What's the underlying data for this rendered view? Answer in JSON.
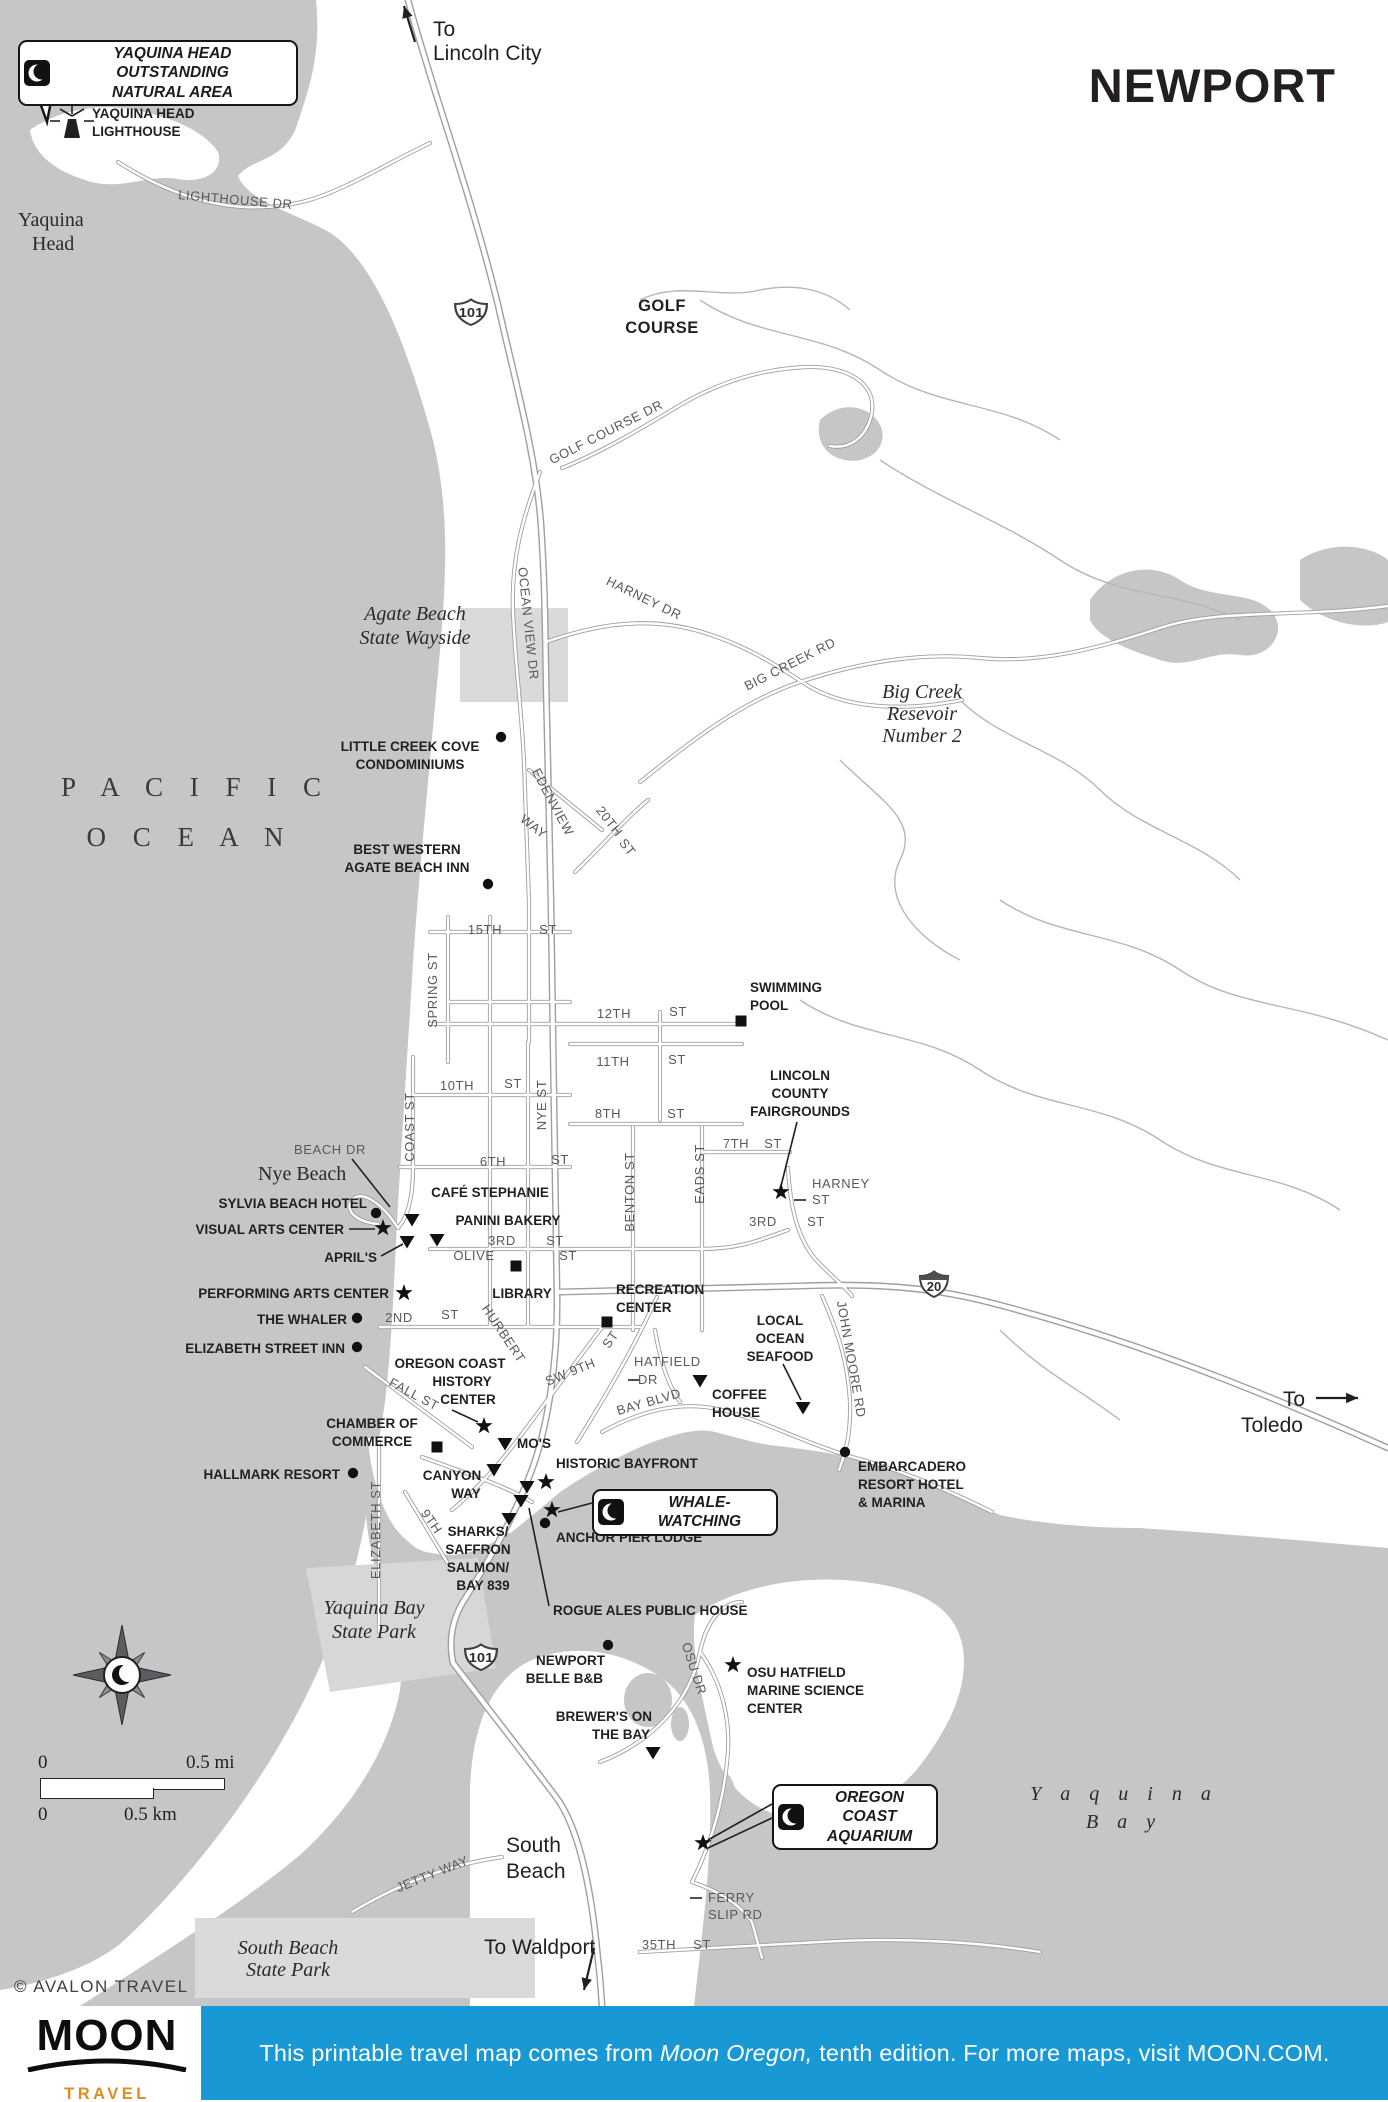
{
  "title": "NEWPORT",
  "attribution": "© AVALON TRAVEL",
  "colors": {
    "ocean": "#c5c6c8",
    "patch": "#d9dadc",
    "road_casing": "#9d9fa2",
    "road_fill": "#ffffff",
    "creek": "#b5b6b8",
    "text": "#231f20",
    "road_text": "#58595b",
    "footer_blue": "#1899d6",
    "logo_orange": "#e08a28"
  },
  "footer": {
    "logo_word": "MOON",
    "logo_sub": "TRAVEL GUIDES",
    "text_pre": "This printable travel map comes from ",
    "text_em": "Moon Oregon,",
    "text_post": " tenth edition. For more maps, visit MOON.COM."
  },
  "scalebar": {
    "mi0": "0",
    "mi1": "0.5 mi",
    "km0": "0",
    "km1": "0.5 km"
  },
  "callouts": [
    {
      "id": "yaquina-head-ona",
      "lines": [
        "YAQUINA HEAD OUTSTANDING",
        "NATURAL AREA"
      ],
      "x": 18,
      "y": 40,
      "w": 280,
      "h": 50
    },
    {
      "id": "whale-watching",
      "lines": [
        "WHALE-WATCHING"
      ],
      "x": 592,
      "y": 1489,
      "w": 186,
      "h": 30
    },
    {
      "id": "oregon-coast-aquarium",
      "lines": [
        "OREGON COAST",
        "AQUARIUM"
      ],
      "x": 772,
      "y": 1784,
      "w": 166,
      "h": 52
    }
  ],
  "shields": [
    {
      "n": "101",
      "x": 471,
      "y": 312,
      "w": 34,
      "band": false
    },
    {
      "n": "101",
      "x": 481,
      "y": 1657,
      "w": 34,
      "band": false
    },
    {
      "n": "20",
      "x": 934,
      "y": 1284,
      "w": 30,
      "band": true
    }
  ],
  "arrows": [
    {
      "x1": 415,
      "y1": 42,
      "x2": 404,
      "y2": 6
    },
    {
      "x1": 1316,
      "y1": 1398,
      "x2": 1358,
      "y2": 1398
    },
    {
      "x1": 594,
      "y1": 1948,
      "x2": 584,
      "y2": 1990
    }
  ],
  "leaders": [
    [
      797,
      1122,
      781,
      1186
    ],
    [
      783,
      1364,
      801,
      1400
    ],
    [
      549,
      1606,
      529,
      1508
    ],
    [
      349,
      1229,
      375,
      1229
    ],
    [
      381,
      1256,
      403,
      1244
    ],
    [
      592,
      1503,
      558,
      1512
    ],
    [
      772,
      1804,
      708,
      1840
    ],
    [
      772,
      1818,
      708,
      1848
    ],
    [
      452,
      1410,
      478,
      1422
    ],
    [
      352,
      1159,
      390,
      1207
    ],
    [
      628,
      1380,
      640,
      1380
    ],
    [
      794,
      1200,
      806,
      1200
    ],
    [
      690,
      1898,
      702,
      1898
    ]
  ],
  "markers": [
    {
      "k": "dot",
      "x": 501,
      "y": 737
    },
    {
      "k": "dot",
      "x": 488,
      "y": 884
    },
    {
      "k": "dot",
      "x": 376,
      "y": 1213
    },
    {
      "k": "dot",
      "x": 357,
      "y": 1318
    },
    {
      "k": "dot",
      "x": 357,
      "y": 1347
    },
    {
      "k": "dot",
      "x": 353,
      "y": 1473
    },
    {
      "k": "dot",
      "x": 545,
      "y": 1523
    },
    {
      "k": "dot",
      "x": 845,
      "y": 1452
    },
    {
      "k": "dot",
      "x": 608,
      "y": 1645
    },
    {
      "k": "star",
      "x": 383,
      "y": 1228
    },
    {
      "k": "star",
      "x": 404,
      "y": 1293
    },
    {
      "k": "star",
      "x": 781,
      "y": 1192
    },
    {
      "k": "star",
      "x": 546,
      "y": 1482
    },
    {
      "k": "star",
      "x": 552,
      "y": 1510
    },
    {
      "k": "star",
      "x": 733,
      "y": 1665
    },
    {
      "k": "star",
      "x": 703,
      "y": 1843
    },
    {
      "k": "star",
      "x": 484,
      "y": 1426
    },
    {
      "k": "tri",
      "x": 412,
      "y": 1220
    },
    {
      "k": "tri",
      "x": 437,
      "y": 1240
    },
    {
      "k": "tri",
      "x": 407,
      "y": 1242
    },
    {
      "k": "tri",
      "x": 700,
      "y": 1381
    },
    {
      "k": "tri",
      "x": 803,
      "y": 1408
    },
    {
      "k": "tri",
      "x": 494,
      "y": 1470
    },
    {
      "k": "tri",
      "x": 527,
      "y": 1487
    },
    {
      "k": "tri",
      "x": 521,
      "y": 1501
    },
    {
      "k": "tri",
      "x": 509,
      "y": 1519
    },
    {
      "k": "tri",
      "x": 653,
      "y": 1753
    },
    {
      "k": "tri",
      "x": 505,
      "y": 1444
    },
    {
      "k": "sq",
      "x": 741,
      "y": 1021
    },
    {
      "k": "sq",
      "x": 516,
      "y": 1266
    },
    {
      "k": "sq",
      "x": 607,
      "y": 1322
    },
    {
      "k": "sq",
      "x": 437,
      "y": 1447
    }
  ],
  "labels": [
    {
      "t": "To",
      "x": 433,
      "y": 36,
      "c": "plain",
      "a": "s"
    },
    {
      "t": "Lincoln City",
      "x": 433,
      "y": 60,
      "c": "plain",
      "a": "s"
    },
    {
      "t": "YAQUINA HEAD",
      "x": 92,
      "y": 118,
      "c": "poi",
      "a": "s"
    },
    {
      "t": "LIGHTHOUSE",
      "x": 92,
      "y": 136,
      "c": "poi",
      "a": "s"
    },
    {
      "t": "Yaquina",
      "x": 18,
      "y": 226,
      "c": "placer",
      "a": "s"
    },
    {
      "t": "Head",
      "x": 32,
      "y": 250,
      "c": "placer",
      "a": "s"
    },
    {
      "t": "LIGHTHOUSE DR",
      "x": 235,
      "y": 204,
      "c": "road",
      "r": 5
    },
    {
      "t": "GOLF",
      "x": 662,
      "y": 311,
      "c": "poilg"
    },
    {
      "t": "COURSE",
      "x": 662,
      "y": 333,
      "c": "poilg"
    },
    {
      "t": "GOLF COURSE DR",
      "x": 608,
      "y": 436,
      "c": "road",
      "r": -27
    },
    {
      "t": "Agate Beach",
      "x": 415,
      "y": 620,
      "c": "place"
    },
    {
      "t": "State Wayside",
      "x": 415,
      "y": 644,
      "c": "place"
    },
    {
      "t": "OCEAN VIEW DR",
      "x": 524,
      "y": 624,
      "c": "road",
      "r": 84
    },
    {
      "t": "HARNEY DR",
      "x": 642,
      "y": 602,
      "c": "road",
      "r": 26
    },
    {
      "t": "BIG CREEK RD",
      "x": 792,
      "y": 668,
      "c": "road",
      "r": -27
    },
    {
      "t": "Big Creek",
      "x": 922,
      "y": 698,
      "c": "place"
    },
    {
      "t": "Resevoir",
      "x": 922,
      "y": 720,
      "c": "place"
    },
    {
      "t": "Number 2",
      "x": 922,
      "y": 742,
      "c": "place"
    },
    {
      "t": "P A C I F I C",
      "x": 196,
      "y": 796,
      "c": "ocean"
    },
    {
      "t": "O C E A N",
      "x": 190,
      "y": 846,
      "c": "ocean"
    },
    {
      "t": "LITTLE CREEK COVE",
      "x": 410,
      "y": 751,
      "c": "poi"
    },
    {
      "t": "CONDOMINIUMS",
      "x": 410,
      "y": 769,
      "c": "poi"
    },
    {
      "t": "BEST WESTERN",
      "x": 407,
      "y": 854,
      "c": "poi"
    },
    {
      "t": "AGATE BEACH INN",
      "x": 407,
      "y": 872,
      "c": "poi"
    },
    {
      "t": "EDENVIEW",
      "x": 549,
      "y": 804,
      "c": "road",
      "r": 62
    },
    {
      "t": "WAY",
      "x": 531,
      "y": 830,
      "c": "road",
      "r": 38
    },
    {
      "t": "20TH",
      "x": 606,
      "y": 824,
      "c": "road",
      "r": 52
    },
    {
      "t": "ST",
      "x": 624,
      "y": 850,
      "c": "road",
      "r": 52
    },
    {
      "t": "SWIMMING",
      "x": 750,
      "y": 992,
      "c": "poi",
      "a": "s"
    },
    {
      "t": "POOL",
      "x": 750,
      "y": 1010,
      "c": "poi",
      "a": "s"
    },
    {
      "t": "15TH",
      "x": 485,
      "y": 934,
      "c": "road"
    },
    {
      "t": "ST",
      "x": 548,
      "y": 934,
      "c": "road"
    },
    {
      "t": "SPRING ST",
      "x": 437,
      "y": 990,
      "c": "road",
      "r": -90
    },
    {
      "t": "12TH",
      "x": 614,
      "y": 1018,
      "c": "road"
    },
    {
      "t": "ST",
      "x": 678,
      "y": 1016,
      "c": "road"
    },
    {
      "t": "11TH",
      "x": 613,
      "y": 1066,
      "c": "road"
    },
    {
      "t": "ST",
      "x": 677,
      "y": 1064,
      "c": "road"
    },
    {
      "t": "8TH",
      "x": 608,
      "y": 1118,
      "c": "road"
    },
    {
      "t": "ST",
      "x": 676,
      "y": 1118,
      "c": "road"
    },
    {
      "t": "10TH",
      "x": 457,
      "y": 1090,
      "c": "road"
    },
    {
      "t": "ST",
      "x": 513,
      "y": 1088,
      "c": "road"
    },
    {
      "t": "LINCOLN",
      "x": 800,
      "y": 1080,
      "c": "poi"
    },
    {
      "t": "COUNTY",
      "x": 800,
      "y": 1098,
      "c": "poi"
    },
    {
      "t": "FAIRGROUNDS",
      "x": 800,
      "y": 1116,
      "c": "poi"
    },
    {
      "t": "7TH",
      "x": 736,
      "y": 1148,
      "c": "road"
    },
    {
      "t": "ST",
      "x": 773,
      "y": 1148,
      "c": "road"
    },
    {
      "t": "6TH",
      "x": 493,
      "y": 1166,
      "c": "road"
    },
    {
      "t": "ST",
      "x": 560,
      "y": 1164,
      "c": "road"
    },
    {
      "t": "NYE ST",
      "x": 546,
      "y": 1105,
      "c": "road",
      "r": -90
    },
    {
      "t": "COAST ST",
      "x": 414,
      "y": 1127,
      "c": "road",
      "r": -90
    },
    {
      "t": "BENTON ST",
      "x": 634,
      "y": 1192,
      "c": "road",
      "r": -90
    },
    {
      "t": "EADS ST",
      "x": 704,
      "y": 1174,
      "c": "road",
      "r": -90
    },
    {
      "t": "BEACH DR",
      "x": 330,
      "y": 1154,
      "c": "road"
    },
    {
      "t": "Nye Beach",
      "x": 258,
      "y": 1180,
      "c": "placer",
      "a": "s"
    },
    {
      "t": "HARNEY",
      "x": 812,
      "y": 1188,
      "c": "road",
      "a": "s"
    },
    {
      "t": "ST",
      "x": 812,
      "y": 1204,
      "c": "road",
      "a": "s"
    },
    {
      "t": "3RD",
      "x": 763,
      "y": 1226,
      "c": "road"
    },
    {
      "t": "ST",
      "x": 816,
      "y": 1226,
      "c": "road"
    },
    {
      "t": "CAFÉ STEPHANIE",
      "x": 490,
      "y": 1197,
      "c": "poi"
    },
    {
      "t": "SYLVIA BEACH HOTEL",
      "x": 367,
      "y": 1208,
      "c": "poi",
      "a": "e"
    },
    {
      "t": "PANINI BAKERY",
      "x": 508,
      "y": 1225,
      "c": "poi"
    },
    {
      "t": "VISUAL ARTS CENTER",
      "x": 344,
      "y": 1234,
      "c": "poi",
      "a": "e"
    },
    {
      "t": "3RD",
      "x": 502,
      "y": 1245,
      "c": "road"
    },
    {
      "t": "ST",
      "x": 555,
      "y": 1245,
      "c": "road"
    },
    {
      "t": "OLIVE",
      "x": 474,
      "y": 1260,
      "c": "road"
    },
    {
      "t": "ST",
      "x": 568,
      "y": 1260,
      "c": "road"
    },
    {
      "t": "APRIL'S",
      "x": 377,
      "y": 1262,
      "c": "poi",
      "a": "e"
    },
    {
      "t": "PERFORMING ARTS CENTER",
      "x": 389,
      "y": 1298,
      "c": "poi",
      "a": "e"
    },
    {
      "t": "LIBRARY",
      "x": 522,
      "y": 1298,
      "c": "poi"
    },
    {
      "t": "RECREATION",
      "x": 616,
      "y": 1294,
      "c": "poi",
      "a": "s"
    },
    {
      "t": "CENTER",
      "x": 616,
      "y": 1312,
      "c": "poi",
      "a": "s"
    },
    {
      "t": "THE WHALER",
      "x": 347,
      "y": 1324,
      "c": "poi",
      "a": "e"
    },
    {
      "t": "2ND",
      "x": 399,
      "y": 1322,
      "c": "road"
    },
    {
      "t": "ST",
      "x": 450,
      "y": 1319,
      "c": "road"
    },
    {
      "t": "ELIZABETH STREET INN",
      "x": 345,
      "y": 1353,
      "c": "poi",
      "a": "e"
    },
    {
      "t": "LOCAL",
      "x": 780,
      "y": 1325,
      "c": "poi"
    },
    {
      "t": "OCEAN",
      "x": 780,
      "y": 1343,
      "c": "poi"
    },
    {
      "t": "SEAFOOD",
      "x": 780,
      "y": 1361,
      "c": "poi"
    },
    {
      "t": "JOHN MOORE RD",
      "x": 847,
      "y": 1360,
      "c": "road",
      "r": 80
    },
    {
      "t": "OREGON COAST",
      "x": 450,
      "y": 1368,
      "c": "poi"
    },
    {
      "t": "HISTORY",
      "x": 462,
      "y": 1386,
      "c": "poi"
    },
    {
      "t": "CENTER",
      "x": 468,
      "y": 1404,
      "c": "poi"
    },
    {
      "t": "HURBERT",
      "x": 500,
      "y": 1336,
      "c": "road",
      "r": 56
    },
    {
      "t": "SW 9TH",
      "x": 572,
      "y": 1376,
      "c": "road",
      "r": -22
    },
    {
      "t": "ST",
      "x": 614,
      "y": 1342,
      "c": "road",
      "r": -55
    },
    {
      "t": "HATFIELD",
      "x": 634,
      "y": 1366,
      "c": "road",
      "a": "s"
    },
    {
      "t": "DR",
      "x": 638,
      "y": 1384,
      "c": "road",
      "a": "s"
    },
    {
      "t": "BAY BLVD",
      "x": 650,
      "y": 1406,
      "c": "road",
      "r": -16
    },
    {
      "t": "COFFEE",
      "x": 712,
      "y": 1399,
      "c": "poi",
      "a": "s"
    },
    {
      "t": "HOUSE",
      "x": 712,
      "y": 1417,
      "c": "poi",
      "a": "s"
    },
    {
      "t": "FALL ST",
      "x": 412,
      "y": 1398,
      "c": "road",
      "r": 28
    },
    {
      "t": "CHAMBER OF",
      "x": 372,
      "y": 1428,
      "c": "poi"
    },
    {
      "t": "COMMERCE",
      "x": 372,
      "y": 1446,
      "c": "poi"
    },
    {
      "t": "MO'S",
      "x": 517,
      "y": 1448,
      "c": "poi",
      "a": "s"
    },
    {
      "t": "HISTORIC BAYFRONT",
      "x": 556,
      "y": 1468,
      "c": "poi",
      "a": "s"
    },
    {
      "t": "EMBARCADERO",
      "x": 858,
      "y": 1471,
      "c": "poi",
      "a": "s"
    },
    {
      "t": "RESORT HOTEL",
      "x": 858,
      "y": 1489,
      "c": "poi",
      "a": "s"
    },
    {
      "t": "& MARINA",
      "x": 858,
      "y": 1507,
      "c": "poi",
      "a": "s"
    },
    {
      "t": "HALLMARK RESORT",
      "x": 340,
      "y": 1479,
      "c": "poi",
      "a": "e"
    },
    {
      "t": "CANYON",
      "x": 452,
      "y": 1480,
      "c": "poi"
    },
    {
      "t": "WAY",
      "x": 466,
      "y": 1498,
      "c": "poi"
    },
    {
      "t": "ELIZABETH ST",
      "x": 380,
      "y": 1530,
      "c": "road",
      "r": -90
    },
    {
      "t": "9TH",
      "x": 428,
      "y": 1524,
      "c": "road",
      "r": 55
    },
    {
      "t": "SHARKS/",
      "x": 478,
      "y": 1536,
      "c": "poi"
    },
    {
      "t": "SAFFRON",
      "x": 478,
      "y": 1554,
      "c": "poi"
    },
    {
      "t": "SALMON/",
      "x": 478,
      "y": 1572,
      "c": "poi"
    },
    {
      "t": "BAY 839",
      "x": 483,
      "y": 1590,
      "c": "poi"
    },
    {
      "t": "ANCHOR PIER LODGE",
      "x": 556,
      "y": 1542,
      "c": "poi",
      "a": "s"
    },
    {
      "t": "ROGUE ALES PUBLIC HOUSE",
      "x": 553,
      "y": 1615,
      "c": "poi",
      "a": "s"
    },
    {
      "t": "Yaquina Bay",
      "x": 374,
      "y": 1614,
      "c": "place"
    },
    {
      "t": "State Park",
      "x": 374,
      "y": 1638,
      "c": "place"
    },
    {
      "t": "NEWPORT",
      "x": 605,
      "y": 1665,
      "c": "poi",
      "a": "e"
    },
    {
      "t": "BELLE B&B",
      "x": 603,
      "y": 1683,
      "c": "poi",
      "a": "e"
    },
    {
      "t": "OSU DR",
      "x": 690,
      "y": 1670,
      "c": "road",
      "r": 72
    },
    {
      "t": "OSU HATFIELD",
      "x": 747,
      "y": 1677,
      "c": "poi",
      "a": "s"
    },
    {
      "t": "MARINE SCIENCE",
      "x": 747,
      "y": 1695,
      "c": "poi",
      "a": "s"
    },
    {
      "t": "CENTER",
      "x": 747,
      "y": 1713,
      "c": "poi",
      "a": "s"
    },
    {
      "t": "BREWER'S ON",
      "x": 652,
      "y": 1721,
      "c": "poi",
      "a": "e"
    },
    {
      "t": "THE BAY",
      "x": 650,
      "y": 1739,
      "c": "poi",
      "a": "e"
    },
    {
      "t": "Y a q u i n a",
      "x": 1124,
      "y": 1800,
      "c": "bay"
    },
    {
      "t": "B a y",
      "x": 1124,
      "y": 1828,
      "c": "bay"
    },
    {
      "t": "South",
      "x": 506,
      "y": 1852,
      "c": "plain",
      "a": "s"
    },
    {
      "t": "Beach",
      "x": 506,
      "y": 1878,
      "c": "plain",
      "a": "s"
    },
    {
      "t": "JETTY WAY",
      "x": 434,
      "y": 1878,
      "c": "road",
      "r": -22
    },
    {
      "t": "FERRY",
      "x": 708,
      "y": 1902,
      "c": "road",
      "a": "s"
    },
    {
      "t": "SLIP RD",
      "x": 708,
      "y": 1919,
      "c": "road",
      "a": "s"
    },
    {
      "t": "South Beach",
      "x": 288,
      "y": 1954,
      "c": "place"
    },
    {
      "t": "State Park",
      "x": 288,
      "y": 1976,
      "c": "place"
    },
    {
      "t": "To Waldport",
      "x": 484,
      "y": 1954,
      "c": "plain",
      "a": "s"
    },
    {
      "t": "35TH",
      "x": 659,
      "y": 1949,
      "c": "road"
    },
    {
      "t": "ST",
      "x": 702,
      "y": 1949,
      "c": "road"
    },
    {
      "t": "To",
      "x": 1294,
      "y": 1406,
      "c": "plain"
    },
    {
      "t": "Toledo",
      "x": 1272,
      "y": 1432,
      "c": "plain"
    }
  ]
}
